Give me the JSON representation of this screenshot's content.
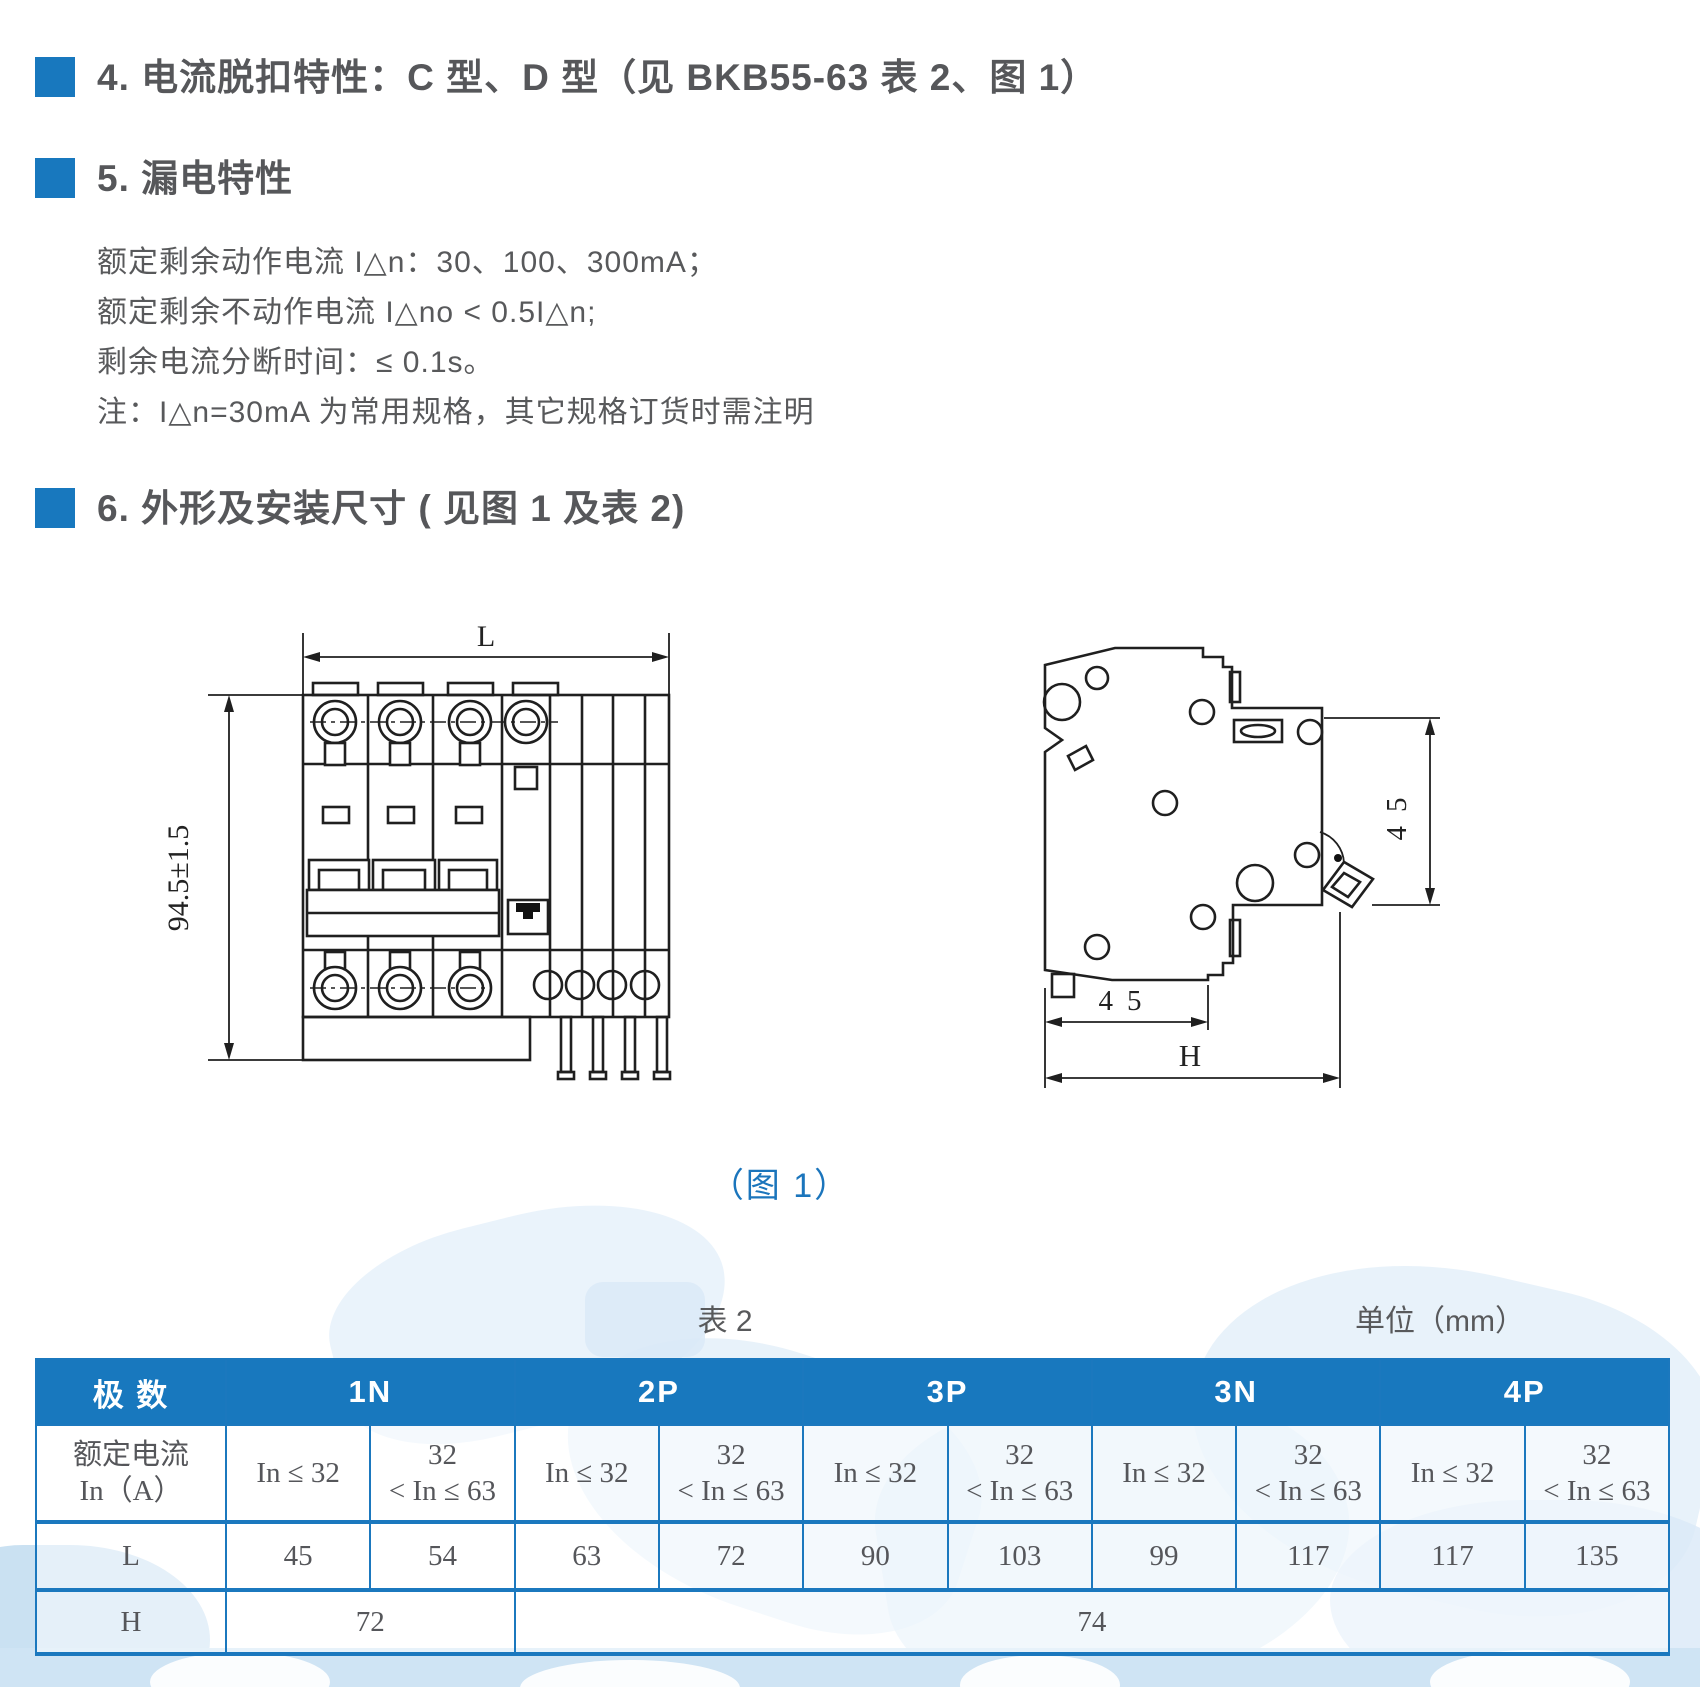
{
  "colors": {
    "accent": "#1878BE",
    "caption_blue": "#1B75BC",
    "heading_gray": "#56575A",
    "table_border": "#1B78BE",
    "watermark": "#D9E9F7"
  },
  "sections": {
    "s4": {
      "title": "4. 电流脱扣特性：C 型、D 型（见 BKB55-63 表 2、图 1）"
    },
    "s5": {
      "title": "5. 漏电特性",
      "lines": [
        "额定剩余动作电流 I△n：30、100、300mA；",
        "额定剩余不动作电流 I△no < 0.5I△n;",
        "剩余电流分断时间：≤ 0.1s。",
        "注：I△n=30mA 为常用规格，其它规格订货时需注明"
      ]
    },
    "s6": {
      "title": "6. 外形及安装尺寸 ( 见图 1 及表 2)"
    }
  },
  "figure": {
    "caption": "（图 1）",
    "front_view": {
      "dim_width": "L",
      "dim_height": "94.5±1.5"
    },
    "side_view": {
      "dim_side": "45",
      "dim_bottom": "45",
      "dim_total": "H"
    }
  },
  "table": {
    "label": "表 2",
    "unit": "单位（mm）",
    "pole_header": "极 数",
    "groups": [
      "1N",
      "2P",
      "3P",
      "3N",
      "4P"
    ],
    "current_row": {
      "label_line1": "额定电流",
      "label_line2": "In（A）",
      "le": "In ≤ 32",
      "range_line1": "32",
      "range_line2": "< In ≤ 63"
    },
    "l_row": {
      "label": "L",
      "values": [
        "45",
        "54",
        "63",
        "72",
        "90",
        "103",
        "99",
        "117",
        "117",
        "135"
      ]
    },
    "h_row": {
      "label": "H",
      "v1": "72",
      "v2": "74"
    }
  }
}
